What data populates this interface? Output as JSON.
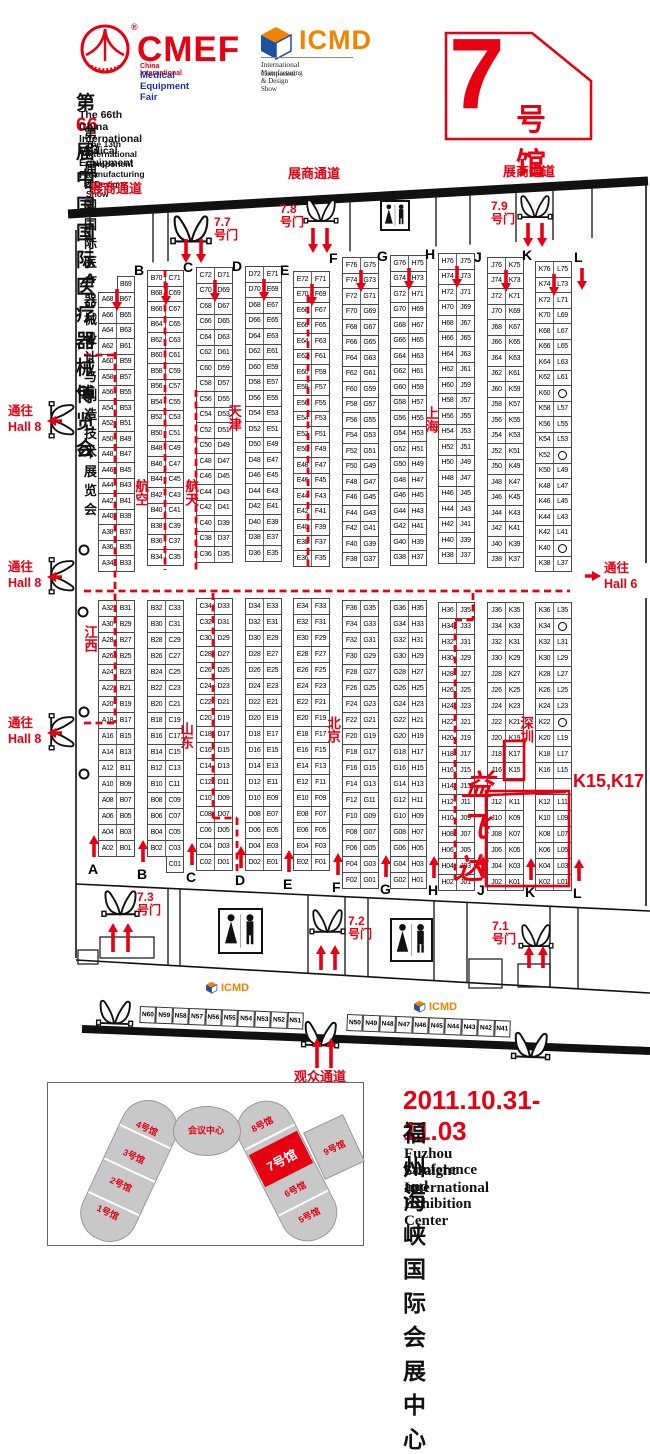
{
  "header": {
    "cmef": {
      "name": "CMEF",
      "reg": "®",
      "line1": "China International",
      "line2": "Medical Equipment Fair"
    },
    "icmd": {
      "name": "ICMD",
      "line1": "International Component",
      "line2": "Manufacturing & Design Show"
    },
    "title_cn_pre": "第",
    "title_cn_num": "66",
    "title_cn_post": "届中国国际医疗器械博览会",
    "title_en": "The 66th China International Medical Equipment Fair",
    "subtitle_cn": "第13届中国国际医疗器械设计与制造技术展览会",
    "subtitle_en": "The 13th International Component Manufacturing & Design Show",
    "badge": {
      "number": "7",
      "suffix": "号馆"
    }
  },
  "plan": {
    "passage_exhibitor": "展商通道",
    "passage_visitor": "观众通道",
    "to_hall8_line1": "通往",
    "to_hall8_line2": "Hall 8",
    "to_hall6_line1": "通往",
    "to_hall6_line2": "Hall 6",
    "doors": {
      "d77": {
        "num": "7.7",
        "word": "号门"
      },
      "d78": {
        "num": "7.8",
        "word": "号门"
      },
      "d79": {
        "num": "7.9",
        "word": "号门"
      },
      "d73": {
        "num": "7.3",
        "word": "号门"
      },
      "d72": {
        "num": "7.2",
        "word": "号门"
      },
      "d71": {
        "num": "7.1",
        "word": "号门"
      }
    },
    "regions": {
      "hangkong": "航空",
      "hangtian": "航天",
      "tianjin": "天津",
      "shanghai": "上海",
      "jiangxi": "江西",
      "shandong": "山东",
      "beijing": "北京",
      "shenzhen": "深圳"
    },
    "brand": {
      "name": "益飞达",
      "booths": "K15,K17"
    },
    "column_letters": [
      "A",
      "B",
      "C",
      "D",
      "E",
      "F",
      "G",
      "H",
      "J",
      "K",
      "L"
    ],
    "strips": [
      {
        "upper": [
          "|B69",
          "A68|B67",
          "A66|B65",
          "A64|B63",
          "A62|B61",
          "A60|B59",
          "A58|B57",
          "A56|B55",
          "A54|B53",
          "A52|B51",
          "A50|B49",
          "A48|B47",
          "A46|B45",
          "A44|B43",
          "A42|B41",
          "A40|B39",
          "A38|B37",
          "A36|B35",
          "A34|B33"
        ],
        "lower": [
          "A32|B31",
          "A30|B29",
          "A28|B27",
          "A26|B25",
          "A24|B23",
          "A22|B21",
          "A20|B19",
          "A18|B17",
          "A16|B15",
          "A14|B13",
          "A12|B11",
          "A10|B09",
          "A08|B07",
          "A06|B05",
          "A04|B03",
          "A02|B01"
        ]
      },
      {
        "upper": [
          "B70|C71",
          "B68|C69",
          "B66|C67",
          "B64|C65",
          "B62|C63",
          "B60|C61",
          "B58|C59",
          "B56|C57",
          "B54|C55",
          "B52|C53",
          "B50|C51",
          "B48|C49",
          "B46|C47",
          "B44|C45",
          "B42|C43",
          "B40|C41",
          "B38|C39",
          "B36|C37",
          "B34|C35"
        ],
        "lower": [
          "B32|C33",
          "B30|C31",
          "B28|C29",
          "B26|C27",
          "B24|C25",
          "B22|C23",
          "B20|C21",
          "B18|C19",
          "B16|C17",
          "B14|C15",
          "B12|C13",
          "B10|C11",
          "B08|C09",
          "B06|C07",
          "B04|C05",
          "B02|C03",
          "|C01"
        ]
      },
      {
        "upper": [
          "C72|D71",
          "C70|D69",
          "C68|D67",
          "C66|D65",
          "C64|D63",
          "C62|D61",
          "C60|D59",
          "C58|D57",
          "C56|D55",
          "C54|D53",
          "C52|D51",
          "C50|D49",
          "C48|D47",
          "C46|D45",
          "C44|D43",
          "C42|D41",
          "C40|D39",
          "C38|D37",
          "C36|D35"
        ],
        "lower": [
          "C34|D33",
          "C32|D31",
          "C30|D29",
          "C28|D27",
          "C26|D25",
          "C24|D23",
          "C22|D21",
          "C20|D19",
          "C18|D17",
          "C16|D15",
          "C14|D13",
          "C12|D11",
          "C10|D09",
          "C08|D07",
          "C06|D05",
          "C04|D03",
          "C02|D01"
        ]
      },
      {
        "upper": [
          "D72|E71",
          "D70|E69",
          "D68|E67",
          "D66|E65",
          "D64|E63",
          "D62|E61",
          "D60|E59",
          "D58|E57",
          "D56|E55",
          "D54|E53",
          "D52|E51",
          "D50|E49",
          "D48|E47",
          "D46|E45",
          "D44|E43",
          "D42|E41",
          "D40|E39",
          "D38|E37",
          "D36|E35"
        ],
        "lower": [
          "D34|E33",
          "D32|E31",
          "D30|E29",
          "D28|E27",
          "D26|E25",
          "D24|E23",
          "D22|E21",
          "D20|E19",
          "D18|E17",
          "D16|E15",
          "D14|E13",
          "D12|E11",
          "D10|E09",
          "D08|E07",
          "D06|E05",
          "D04|E03",
          "D02|E01"
        ]
      },
      {
        "upper": [
          "E72|F71",
          "E70|F69",
          "E68|F67",
          "E66|F65",
          "E64|F63",
          "E62|F61",
          "E60|F59",
          "E58|F57",
          "E56|F55",
          "E54|F53",
          "E52|F51",
          "E50|F49",
          "E48|F47",
          "E46|F45",
          "E44|F43",
          "E42|F41",
          "E40|F39",
          "E38|F37",
          "E36|F35"
        ],
        "lower": [
          "E34|F33",
          "E32|F31",
          "E30|F29",
          "E28|F27",
          "E26|F25",
          "E24|F23",
          "E22|F21",
          "E20|F19",
          "E18|F17",
          "E16|F15",
          "E14|F13",
          "E12|F11",
          "E10|F09",
          "E08|F07",
          "E06|F05",
          "E04|F03",
          "E02|F01"
        ]
      },
      {
        "upper": [
          "F76|G75",
          "F74|G73",
          "F72|G71",
          "F70|G69",
          "F68|G67",
          "F66|G65",
          "F64|G63",
          "F62|G61",
          "F60|G59",
          "F58|G57",
          "F56|G55",
          "F54|G53",
          "F52|G51",
          "F50|G49",
          "F48|G47",
          "F46|G45",
          "F44|G43",
          "F42|G41",
          "F40|G39",
          "F38|G37"
        ],
        "lower": [
          "F36|G35",
          "F34|G33",
          "F32|G31",
          "F30|G29",
          "F28|G27",
          "F26|G25",
          "F24|G23",
          "F22|G21",
          "F20|G19",
          "F18|G17",
          "F16|G15",
          "F14|G13",
          "F12|G11",
          "F10|G09",
          "F08|G07",
          "F06|G05",
          "F04|G03",
          "F02|G01"
        ]
      },
      {
        "upper": [
          "G76|H75",
          "G74|H73",
          "G72|H71",
          "G70|H69",
          "G68|H67",
          "G66|H65",
          "G64|H63",
          "G62|H61",
          "G60|H59",
          "G58|H57",
          "G56|H55",
          "G54|H53",
          "G52|H51",
          "G50|H49",
          "G48|H47",
          "G46|H45",
          "G44|H43",
          "G42|H41",
          "G40|H39",
          "G38|H37"
        ],
        "lower": [
          "G36|H35",
          "G34|H33",
          "G32|H31",
          "G30|H29",
          "G28|H27",
          "G26|H25",
          "G24|H23",
          "G22|H21",
          "G20|H19",
          "G18|H17",
          "G16|H15",
          "G14|H13",
          "G12|H11",
          "G10|H09",
          "G08|H07",
          "G06|H05",
          "G04|H03",
          "G02|H01"
        ]
      },
      {
        "upper": [
          "H76|J75",
          "H74|J73",
          "H72|J71",
          "H70|J69",
          "H68|J67",
          "H66|J65",
          "H64|J63",
          "H62|J61",
          "H60|J59",
          "H58|J57",
          "H56|J55",
          "H54|J53",
          "H52|J51",
          "H50|J49",
          "H48|J47",
          "H46|J45",
          "H44|J43",
          "H42|J41",
          "H40|J39",
          "H38|J37"
        ],
        "lower": [
          "H36|J35",
          "H34|J33",
          "H32|J31",
          "H30|J29",
          "H28|J27",
          "H26|J25",
          "H24|J23",
          "H22|J21",
          "H20|J19",
          "H18|J17",
          "H16|J15",
          "H14|J13",
          "H12|J11",
          "H10|J09",
          "H08|J07",
          "H06|J05",
          "H04|J03",
          "H02|J01"
        ]
      },
      {
        "upper": [
          "J76|K75",
          "J74|K73",
          "J72|K71",
          "J70|K69",
          "J68|K67",
          "J66|K65",
          "J64|K63",
          "J62|K61",
          "J60|K59",
          "J58|K57",
          "J56|K55",
          "J54|K53",
          "J52|K51",
          "J50|K49",
          "J48|K47",
          "J46|K45",
          "J44|K43",
          "J42|K41",
          "J40|K39",
          "J38|K37"
        ],
        "lower": [
          "J36|K35",
          "J34|K33",
          "J32|K31",
          "J30|K29",
          "J28|K27",
          "J26|K25",
          "J24|K23",
          "J22|K21",
          "J20|K19",
          "J18|K17",
          "J16|K15",
          "|",
          "J12|K11",
          "J10|K09",
          "J08|K07",
          "J06|K05",
          "J04|K03",
          "J02|K01"
        ]
      },
      {
        "upper": [
          "K76|L75",
          "K74|L73",
          "K72|L71",
          "K70|L69",
          "K68|L67",
          "K66|L65",
          "K64|L63",
          "K62|L61",
          "K60|○",
          "K58|L57",
          "K56|L55",
          "K54|L53",
          "K52|○",
          "K50|L49",
          "K48|L47",
          "K46|L45",
          "K44|L43",
          "K42|L41",
          "K40|○",
          "K38|L37"
        ],
        "lower": [
          "K36|L35",
          "K34|○",
          "K32|L31",
          "K30|L29",
          "K28|L27",
          "K26|L25",
          "K24|L23",
          "K22|○",
          "K20|L19",
          "K18|L17",
          "K16|L15",
          "|",
          "K12|L11",
          "K10|L09",
          "K08|L07",
          "K06|L05",
          "K04|L03",
          "K02|L01"
        ]
      }
    ],
    "n_row": {
      "left": [
        "N60",
        "N59",
        "N58",
        "N57",
        "N56",
        "N55",
        "N54",
        "N53",
        "N52",
        "N51"
      ],
      "right": [
        "N50",
        "N49",
        "N48",
        "N47",
        "N46",
        "N45",
        "N44",
        "N43",
        "N42",
        "N41"
      ]
    }
  },
  "minimap": {
    "center": "会议中心",
    "halls": {
      "h1": "1号馆",
      "h2": "2号馆",
      "h3": "3号馆",
      "h4": "4号馆",
      "h5": "5号馆",
      "h6": "6号馆",
      "h7": "7号馆",
      "h8": "8号馆",
      "h9": "9号馆"
    }
  },
  "footer": {
    "date": "2011.10.31-11.03",
    "venue_cn": "福州海峡国际会展中心",
    "venue_en1": "Fuzhou Straight International",
    "venue_en2": "Conference and Exhibition Center"
  }
}
